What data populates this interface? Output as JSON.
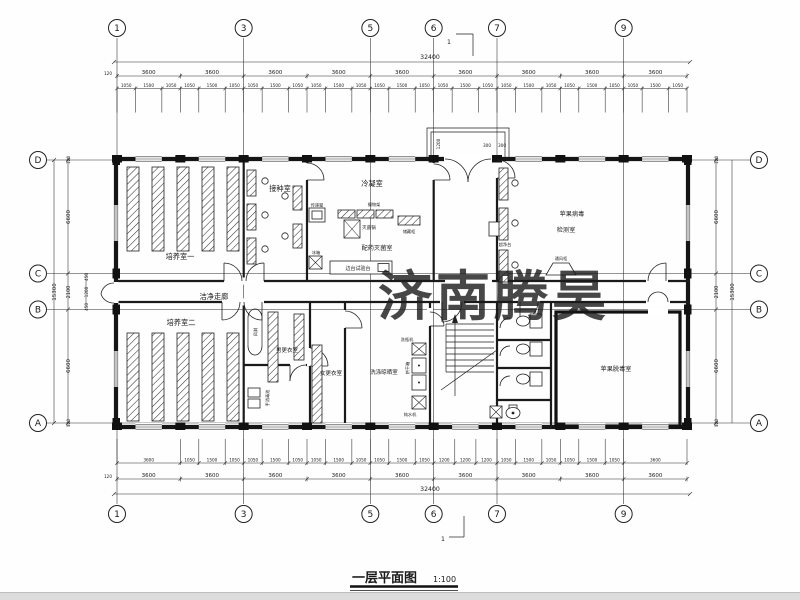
{
  "title": {
    "text": "一层平面图",
    "scale": "1:100"
  },
  "watermark": "济南腾昊",
  "section": {
    "label": "1"
  },
  "axes": {
    "h": [
      "1",
      "3",
      "5",
      "6",
      "7",
      "9"
    ],
    "v": [
      "D",
      "C",
      "B",
      "A"
    ]
  },
  "dims": {
    "overall_w": "32400",
    "overall_h": "15300",
    "offset": "120",
    "bays": [
      "3600",
      "3600",
      "3600",
      "3600",
      "3600",
      "3600",
      "3600",
      "3600",
      "3600"
    ],
    "top_subs": [
      "1050",
      "1500",
      "1050",
      "1050",
      "1500",
      "1050",
      "1050",
      "1500",
      "1050",
      "1050",
      "1500",
      "1050",
      "1050",
      "1500",
      "1050",
      "1050",
      "1500",
      "1050",
      "1050",
      "1500",
      "1050",
      "1050",
      "1500",
      "1050",
      "1050",
      "1500",
      "1050"
    ],
    "bottom_subs": [
      "3600",
      "1050",
      "1500",
      "1050",
      "1050",
      "1500",
      "1050",
      "1050",
      "1500",
      "1050",
      "1050",
      "1500",
      "1050",
      "1200",
      "1200",
      "1200",
      "1050",
      "1500",
      "1050",
      "1050",
      "1500",
      "1050",
      "3600"
    ],
    "side": [
      "120",
      "6600",
      "2100",
      "6600",
      "120"
    ],
    "corridor": [
      "450",
      "1200",
      "450"
    ],
    "entrance": {
      "depth": "1200",
      "w1": "300",
      "w2": "300"
    }
  },
  "rooms": {
    "culture1": "培养室一",
    "culture2": "培养室二",
    "inoculation": "接种室",
    "condensation": "冷凝室",
    "prep": "配药灭菌室",
    "corridor": "洁净走廊",
    "virus_line1": "苹果病毒",
    "virus_line2": "检测室",
    "detox": "苹果脱毒室",
    "men_change": "男更衣室",
    "women_change": "女更衣室",
    "washing": "洗涤晾晒室"
  },
  "equipment": {
    "pass": "传递窗",
    "fridge": "冰箱",
    "shelf": "搁物架",
    "sterilizer": "灭菌锅",
    "cabinet": "储藏柜",
    "bench": "边台试验台",
    "clean_bench": "超净台",
    "fume": "通风柜",
    "air_shower": "风淋",
    "bottle_washer": "洗瓶机",
    "dryer": "烘干箱",
    "water": "纯水机",
    "hand_sink": "手消毒池"
  }
}
